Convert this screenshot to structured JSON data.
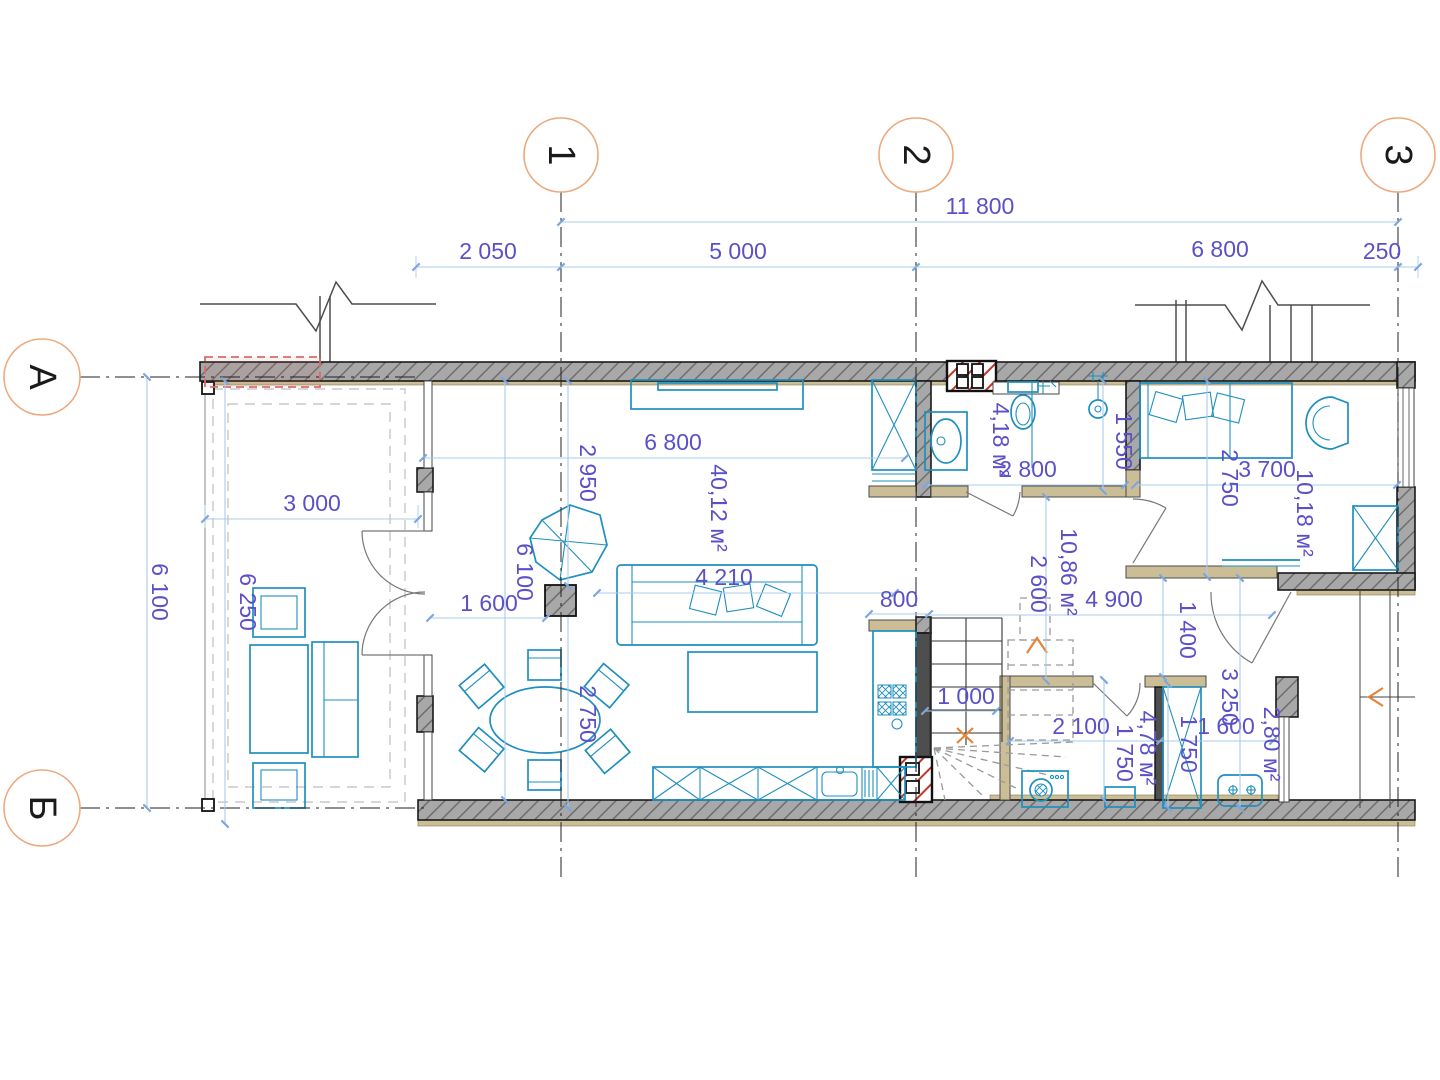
{
  "plan": {
    "axis_labels": {
      "v1": "1",
      "v2": "2",
      "v3": "3",
      "hA": "А",
      "hB": "Б"
    },
    "dims": {
      "overall_top": "11 800",
      "top_2050": "2 050",
      "top_5000": "5 000",
      "top_6800": "6 800",
      "top_250": "250",
      "left_6100": "6 100",
      "terrace_6250": "6 250",
      "terrace_3000": "3 000",
      "living_width": "6 800",
      "living_height": "6 100",
      "living_2950": "2 950",
      "living_1600": "1 600",
      "sofa_4210": "4 210",
      "dining_2750": "2 750",
      "bath_2800": "2 800",
      "bath_1550": "1 550",
      "bed_3700": "3 700",
      "bed_2750": "2 750",
      "hall_2600": "2 600",
      "hall_4900": "4 900",
      "hall_800": "800",
      "hall_1400": "1 400",
      "stairs_1000": "1 000",
      "laundry_2100": "2 100",
      "laundry_1750": "1 750",
      "wardrobe_1750": "1 750",
      "entry_3250": "3 250",
      "entry_1600": "1 600"
    },
    "areas": {
      "living": "40,12 м²",
      "bath": "4,18 м²",
      "hall": "10,86 м²",
      "bedroom": "10,18 м²",
      "laundry": "4,78 м²",
      "entry": "2,80 м²"
    },
    "colors": {
      "dimtext": "#5B50C8",
      "dimline": "#A9CBEA",
      "dimtick": "#7DA7DC",
      "furn": "#1E8FBE",
      "wallfill": "#A8A8A8",
      "wallhatch": "#6E6E6E",
      "tan": "#CBBE96",
      "red": "#C0392B",
      "orange": "#E8833A",
      "axis": "#ECA97E",
      "door": "#777777"
    }
  }
}
